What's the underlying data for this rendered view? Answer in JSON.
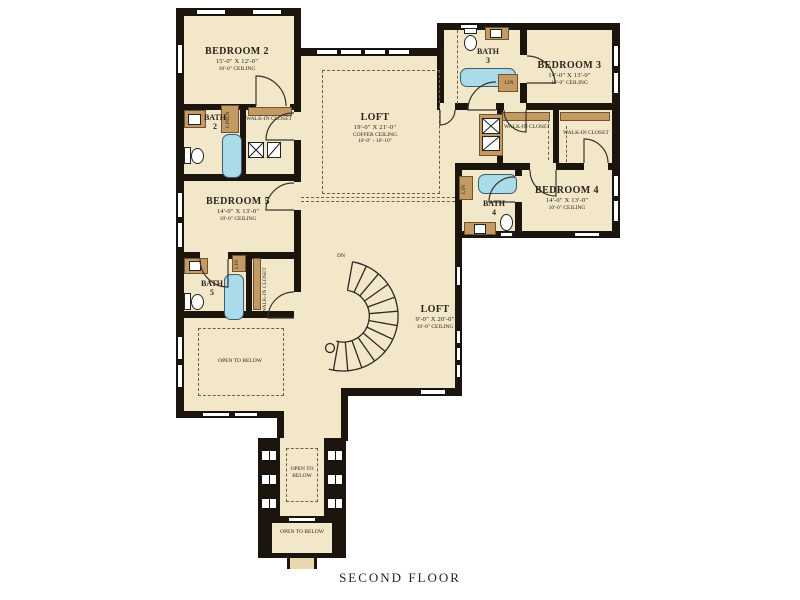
{
  "title": "SECOND FLOOR",
  "colors": {
    "floor": "#f2e7c9",
    "wall": "#1b150e",
    "wood_accent": "#c49a63",
    "tub": "#aadbe9",
    "balcony_floor": "#e8d8ad"
  },
  "rooms": {
    "bedroom2": {
      "name": "BEDROOM 2",
      "dims": "15'-0\" X 12'-0\"",
      "ceiling": "10'-0\" CEILING"
    },
    "bedroom3": {
      "name": "BEDROOM 3",
      "dims": "14'-0\" X 13'-0\"",
      "ceiling": "10'-0\" CEILING"
    },
    "bedroom4": {
      "name": "BEDROOM 4",
      "dims": "14'-0\" X 13'-0\"",
      "ceiling": "10'-0\" CEILING"
    },
    "bedroom5": {
      "name": "BEDROOM 5",
      "dims": "14'-0\" X 13'-0\"",
      "ceiling": "10'-0\" CEILING"
    },
    "loft_upper": {
      "name": "LOFT",
      "dims": "19'-0\" X 21'-0\"",
      "ceiling_type": "COFFER CEILING",
      "ceiling": "10'-0\" - 10'-10\""
    },
    "loft_lower": {
      "name": "LOFT",
      "dims": "9'-0\" X 20'-0\"",
      "ceiling": "10'-0\" CEILING"
    },
    "bath2": {
      "name": "BATH",
      "number": "2"
    },
    "bath3": {
      "name": "BATH",
      "number": "3"
    },
    "bath4": {
      "name": "BATH",
      "number": "4"
    },
    "bath5": {
      "name": "BATH",
      "number": "5"
    },
    "storage": {
      "name": "STORAGE"
    }
  },
  "closets": {
    "walk_in": "WALK-IN CLOSET",
    "linen": "LINEN",
    "lin": "LIN"
  },
  "annotations": {
    "open_to_below": "OPEN TO BELOW",
    "stairs_down": "DN"
  }
}
